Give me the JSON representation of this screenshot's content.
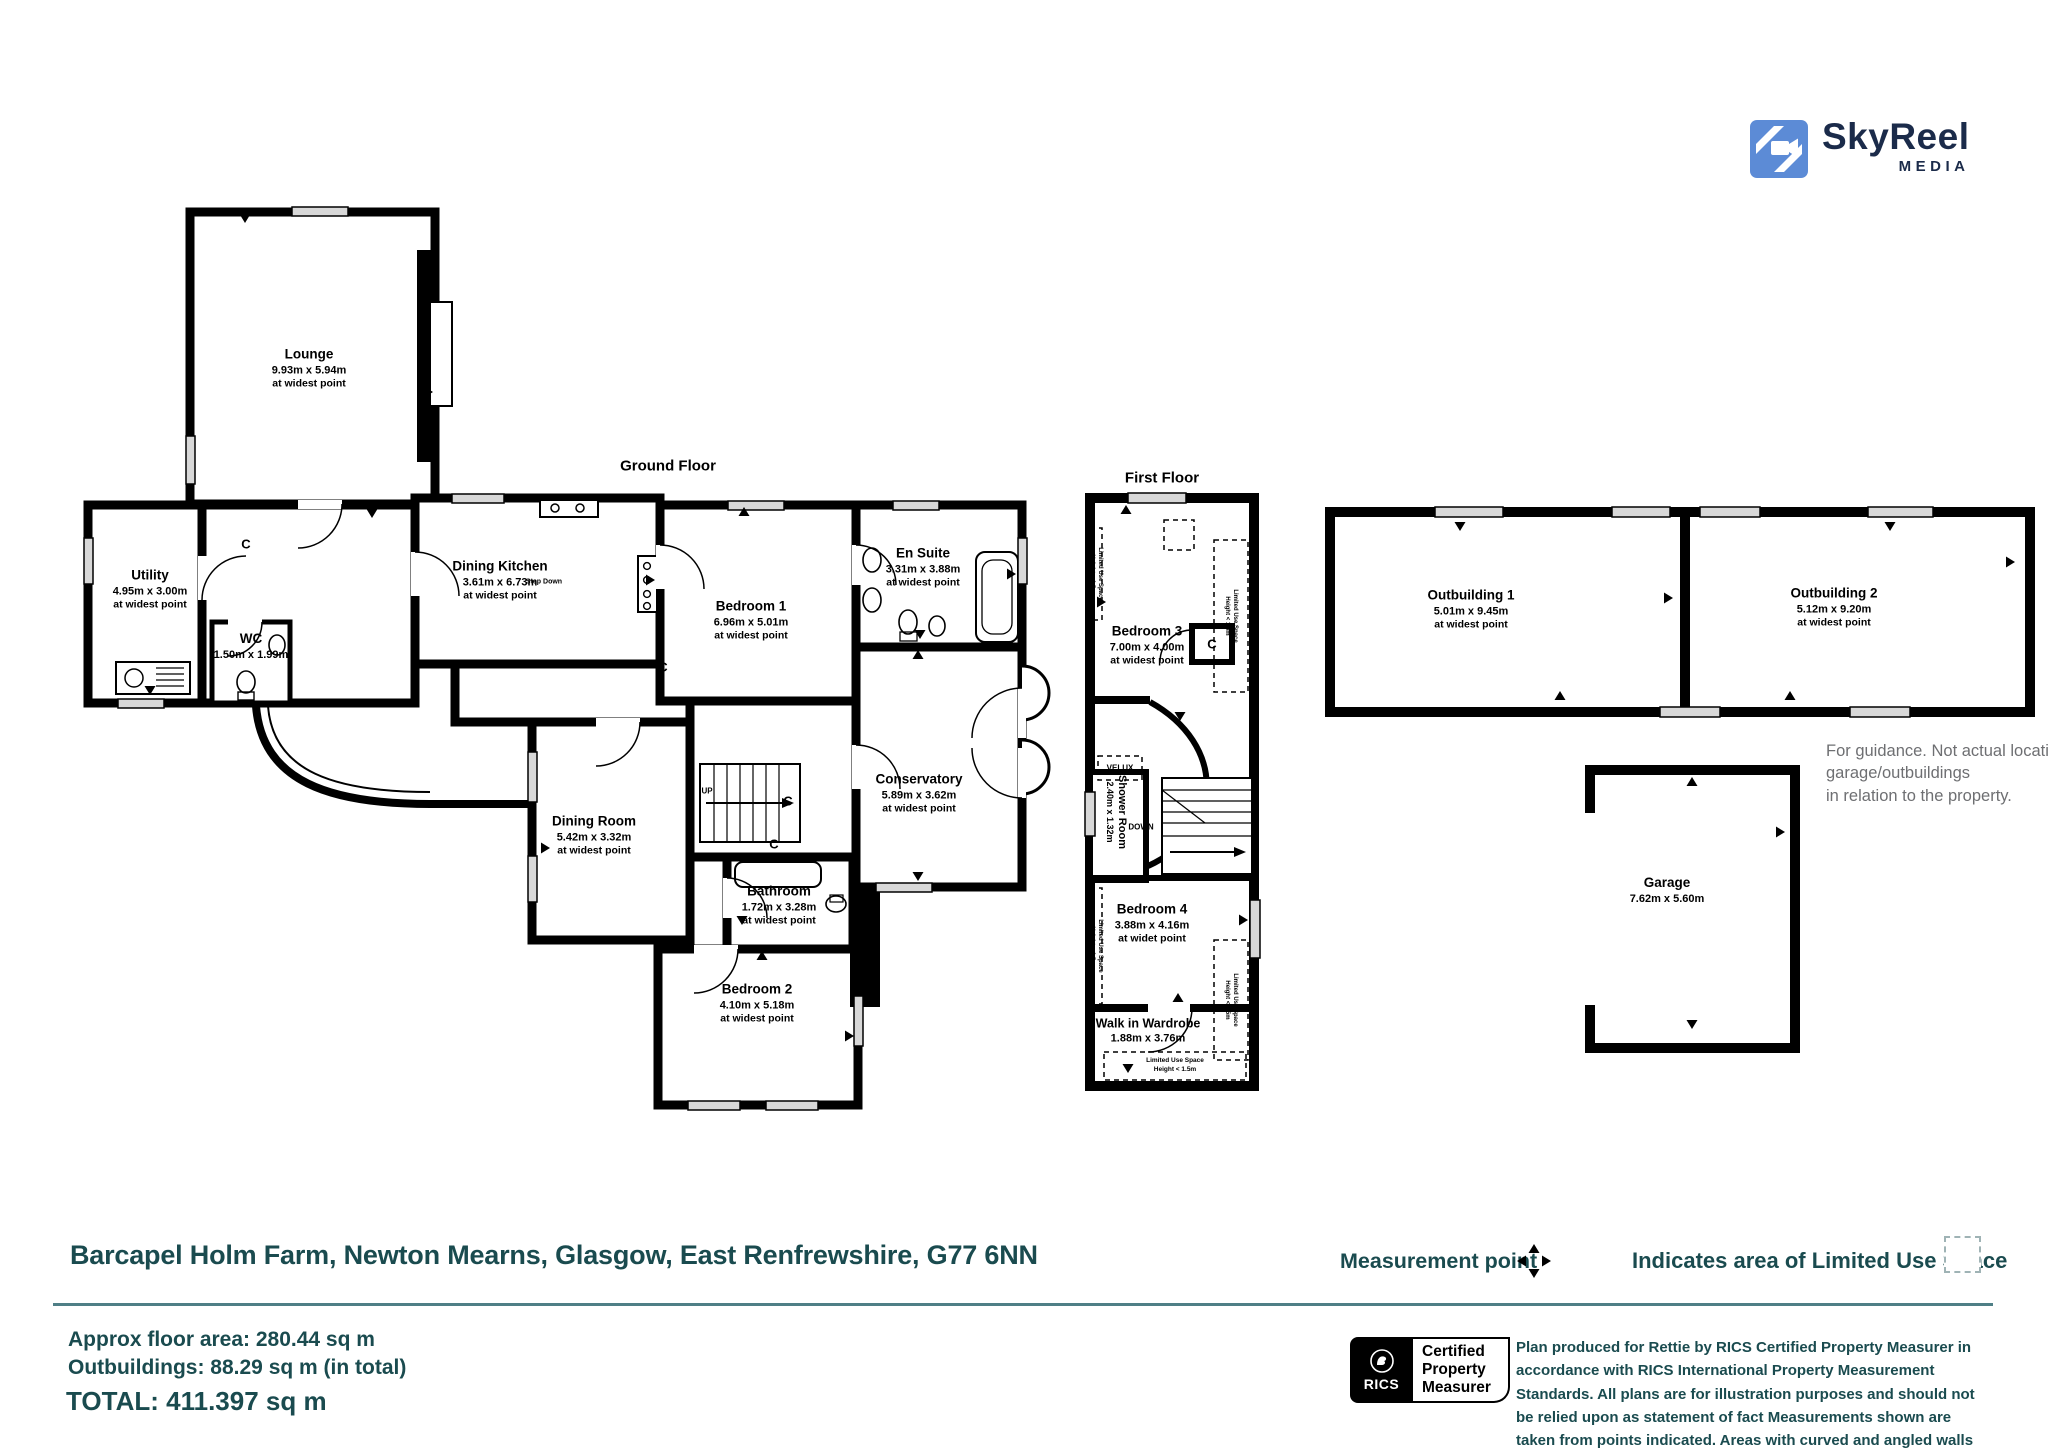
{
  "logo": {
    "brand": "SkyReel",
    "media": "MEDIA"
  },
  "floor_titles": {
    "ground": "Ground Floor",
    "first": "First Floor"
  },
  "rooms": {
    "lounge": {
      "name": "Lounge",
      "dims": "9.93m x 5.94m",
      "note": "at widest point"
    },
    "utility": {
      "name": "Utility",
      "dims": "4.95m x 3.00m",
      "note": "at widest point"
    },
    "wc": {
      "name": "WC",
      "dims": "1.50m x 1.99m"
    },
    "dining_kitchen": {
      "name": "Dining Kitchen",
      "dims": "3.61m x 6.73m",
      "note": "at widest point"
    },
    "bedroom1": {
      "name": "Bedroom 1",
      "dims": "6.96m x 5.01m",
      "note": "at widest point"
    },
    "en_suite": {
      "name": "En Suite",
      "dims": "3.31m x 3.88m",
      "note": "at widest point"
    },
    "conservatory": {
      "name": "Conservatory",
      "dims": "5.89m x 3.62m",
      "note": "at widest point"
    },
    "dining_room": {
      "name": "Dining Room",
      "dims": "5.42m x 3.32m",
      "note": "at widest point"
    },
    "bathroom": {
      "name": "Bathroom",
      "dims": "1.72m x 3.28m",
      "note": "at widest point"
    },
    "bedroom2": {
      "name": "Bedroom 2",
      "dims": "4.10m x 5.18m",
      "note": "at widest point"
    },
    "bedroom3": {
      "name": "Bedroom 3",
      "dims": "7.00m x 4.00m",
      "note": "at widest point"
    },
    "shower_room": {
      "name": "Shower Room",
      "dims": "2.40m x 1.32m"
    },
    "bedroom4": {
      "name": "Bedroom 4",
      "dims": "3.88m x 4.16m",
      "note": "at widet point"
    },
    "wardrobe": {
      "name": "Walk in Wardrobe",
      "dims": "1.88m x 3.76m"
    },
    "outbuilding1": {
      "name": "Outbuilding 1",
      "dims": "5.01m x 9.45m",
      "note": "at widest point"
    },
    "outbuilding2": {
      "name": "Outbuilding 2",
      "dims": "5.12m x 9.20m",
      "note": "at widest point"
    },
    "garage": {
      "name": "Garage",
      "dims": "7.62m x 5.60m"
    }
  },
  "plan_labels": {
    "cupboard": "C",
    "up": "UP",
    "down": "DOWN",
    "step_down": "Step Down",
    "velux": "VELUX",
    "limited_use": "Limited Use Space",
    "limited_height": "Height < 1.5m"
  },
  "guidance": {
    "line1": "For guidance. Not actual location of",
    "line2": "garage/outbuildings",
    "line3": "in relation to the property."
  },
  "footer": {
    "address": "Barcapel Holm Farm, Newton Mearns, Glasgow, East Renfrewshire, G77 6NN",
    "measurement_point": "Measurement point",
    "limited_use_legend": "Indicates area of  Limited Use Space",
    "approx_area": "Approx floor area: 280.44 sq m",
    "outbuildings_area": "Outbuildings: 88.29 sq m (in total)",
    "total_area": "TOTAL: 411.397 sq m",
    "rics": "RICS",
    "cert_line1": "Certified",
    "cert_line2": "Property",
    "cert_line3": "Measurer",
    "disclaimer": "Plan produced for Rettie by RICS Certified Property Measurer in accordance with RICS International Property  Measurement Standards.  All plans are for illustration purposes and should not be relied upon as statement of fact Measurements shown are taken from points indicated. Areas with curved and angled walls are approximated."
  },
  "colors": {
    "brand_blue": "#5c8bd6",
    "brand_navy": "#1b2b4a",
    "teal_text": "#1a4b4f",
    "divider": "#4f7f86",
    "guidance_gray": "#6e6f72",
    "wall_black": "#000000"
  }
}
